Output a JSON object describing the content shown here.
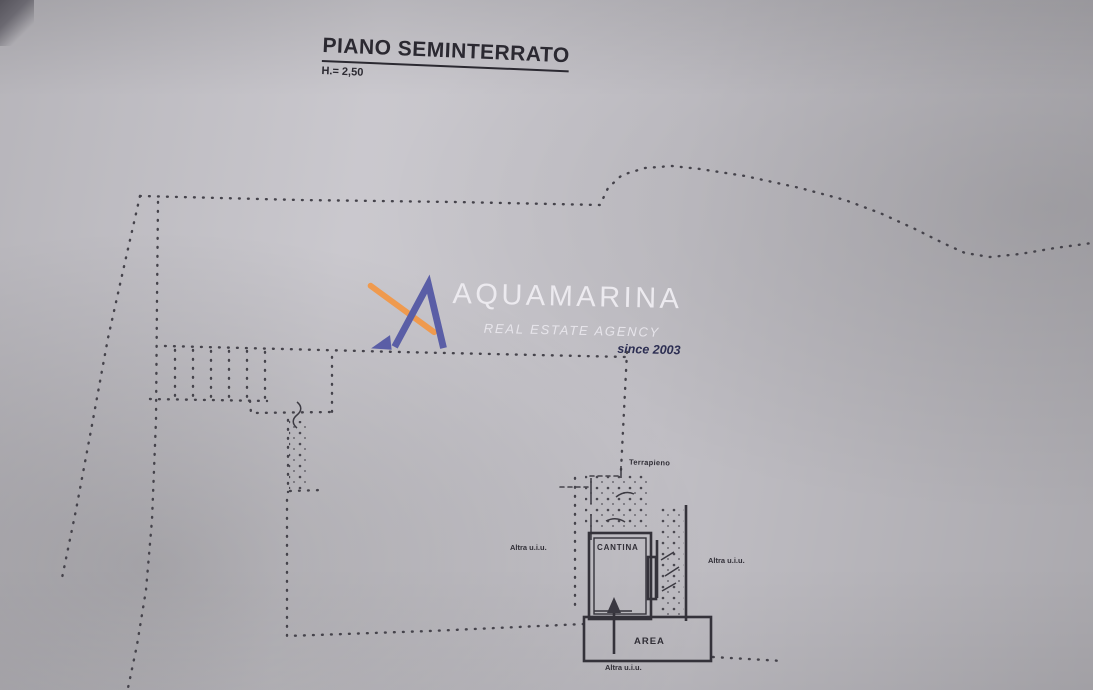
{
  "document": {
    "title": "PIANO SEMINTERRATO",
    "height_note": "H.= 2,50"
  },
  "watermark": {
    "brand": "AQUAMARINA",
    "tagline": "REAL ESTATE AGENCY",
    "since": "since 2003",
    "colors": {
      "mark_blue": "#5a5ea6",
      "mark_orange": "#ef9a4e",
      "text_white": "#eceaef",
      "since_navy": "#2c2e52"
    }
  },
  "plan": {
    "ink_color": "#45434b",
    "wall_color": "#34323a",
    "paper_color": "#c6c4ca",
    "labels": {
      "terrapieno": "Terrapieno",
      "cantina": "CANTINA",
      "area": "AREA",
      "adjacent_left": "Altra u.i.u.",
      "adjacent_right": "Altra u.i.u.",
      "adjacent_bottom": "Altra u.i.u."
    }
  }
}
